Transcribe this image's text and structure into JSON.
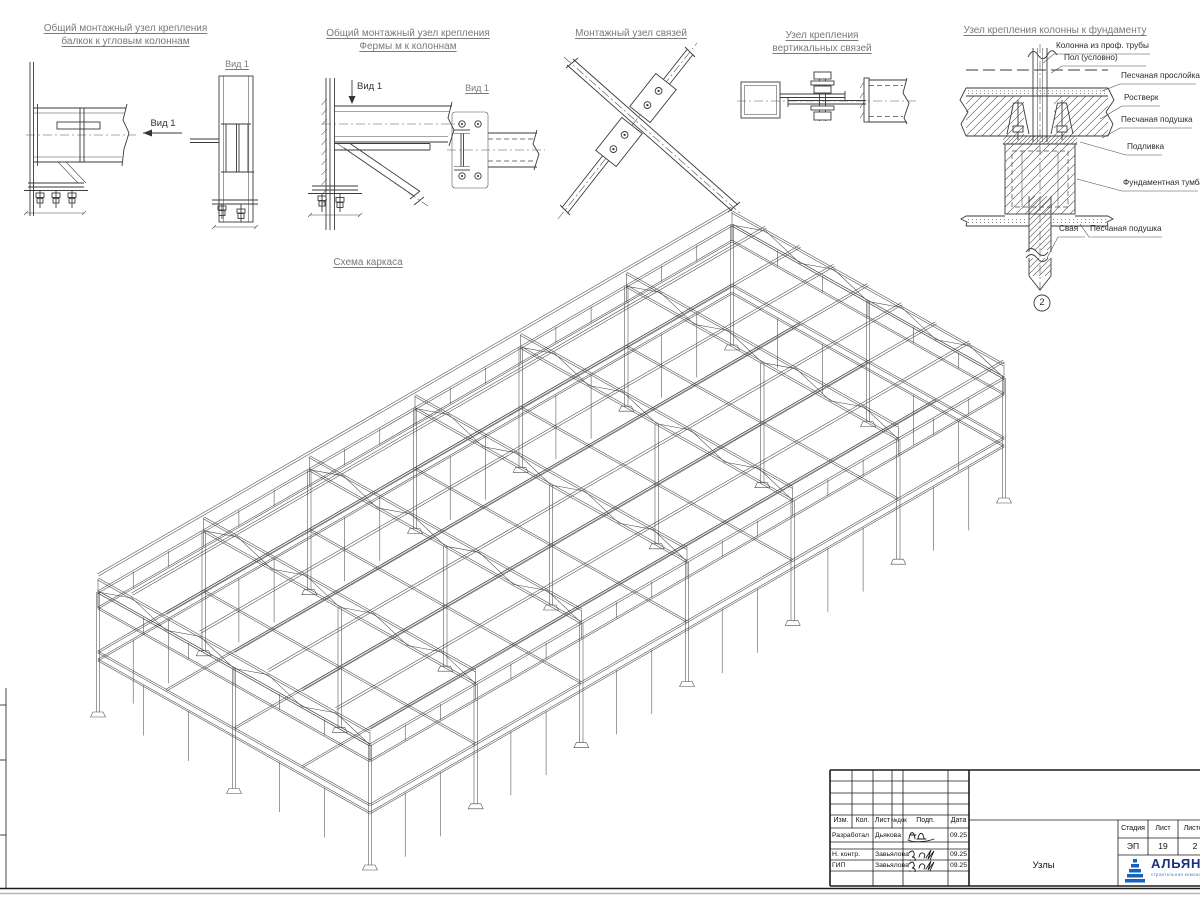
{
  "details": {
    "d1": {
      "title1": "Общий монтажный узел крепления",
      "title2": "балкок к угловым колоннам",
      "view_arrow_label": "Вид 1",
      "view_label": "Вид 1"
    },
    "d2": {
      "title1": "Общий монтажный узел крепления",
      "title2": "Фермы м к колоннам",
      "view_arrow_label": "Вид 1",
      "view_label": "Вид 1"
    },
    "d3": {
      "title": "Монтажный узел связей"
    },
    "d4": {
      "title1": "Узел крепления",
      "title2": "вертикальных связей"
    },
    "d5": {
      "title": "Узел крепления колонны к фундаменту",
      "labels": [
        "Колонна из проф. трубы",
        "Пол (условно)",
        "Песчаная прослойка",
        "Ростверк",
        "Песчаная подушка",
        "Подливка",
        "Фундаментная тумба",
        "Свая",
        "Песчаная подушка"
      ],
      "marker": "2"
    }
  },
  "scheme": {
    "title": "Схема каркаса"
  },
  "titleblock": {
    "headers": [
      "Изм.",
      "Кол.",
      "Лист",
      "№док",
      "Подп.",
      "Дата"
    ],
    "rows": [
      {
        "role": "Разработал",
        "name": "Дьякова",
        "date": "09.25"
      },
      {
        "role": "Н. контр.",
        "name": "Завьялова",
        "date": "09.25"
      },
      {
        "role": "ГИП",
        "name": "Завьялова",
        "date": "09.25"
      }
    ],
    "doc_title": "Узлы",
    "stage_header": "Стадия",
    "stage": "ЭП",
    "sheet_header": "Лист",
    "sheet": "19",
    "sheets_header": "Листов",
    "sheets": "2",
    "logo_text": "АЛЬЯНС",
    "logo_sub": "строительная компания"
  },
  "colors": {
    "line": "#3a3a3a",
    "logo_blue": "#1565c0",
    "logo_navy": "#1b2f7e"
  }
}
